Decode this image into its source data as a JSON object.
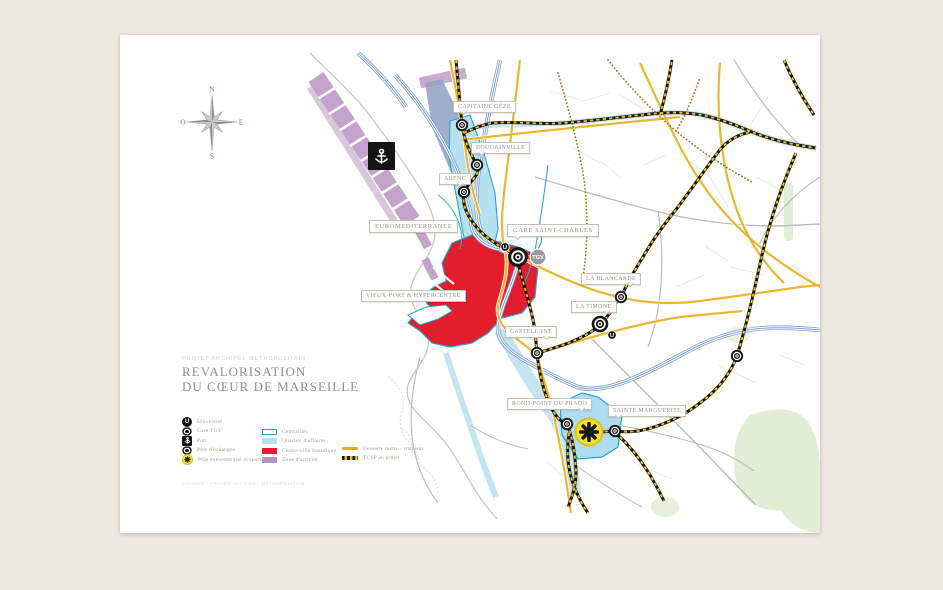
{
  "page": {
    "kicker": "PROJET ARCHIPEL METROPOLITAIN",
    "title_line1": "REVALORISATION",
    "title_line2": "DU CŒUR DE MARSEILLE",
    "credit": "SOURCE : PROJET ARCHIPEL METROPOLITAIN"
  },
  "compass": {
    "north": "N",
    "east": "E",
    "south": "S",
    "west": "O"
  },
  "map": {
    "labels": [
      {
        "id": "capitaine-geze",
        "text": "CAPITAINE GÈZE"
      },
      {
        "id": "bougainville",
        "text": "BOUGAINVILLE"
      },
      {
        "id": "arenc",
        "text": "ARENC"
      },
      {
        "id": "euromediterranee",
        "text": "EUROMEDITERRANEE"
      },
      {
        "id": "gare-saint-charles",
        "text": "GARE SAINT-CHARLES"
      },
      {
        "id": "vieux-port",
        "text": "VIEUX-PORT & HYPERCENTRE"
      },
      {
        "id": "la-blancarde",
        "text": "LA BLANCARDE"
      },
      {
        "id": "la-timone",
        "text": "LA TIMONE"
      },
      {
        "id": "castellane",
        "text": "CASTELLANE"
      },
      {
        "id": "rond-point-du-prado",
        "text": "ROND-POINT DU PRADO"
      },
      {
        "id": "sainte-marguerite",
        "text": "SAINTE MARGUERITE"
      }
    ],
    "badges": {
      "tgv": "TGV",
      "u1": "U",
      "u2": "U"
    }
  },
  "legend": {
    "points": [
      {
        "icon": "universite-icon",
        "label": "Université"
      },
      {
        "icon": "gare-tgv-icon",
        "label": "Gare TGV"
      },
      {
        "icon": "port-icon",
        "label": "Port"
      },
      {
        "icon": "pole-echanges-icon",
        "label": "Pôle d'échanges"
      },
      {
        "icon": "pole-evenementiel-icon",
        "label": "Pôle événementiel et sportif"
      }
    ],
    "areas": [
      {
        "swatch": "teal-outline",
        "label": "Centralités"
      },
      {
        "swatch": "light-blue",
        "label": "Quartier d'affaires"
      },
      {
        "swatch": "red",
        "label": "Centre-ville historique"
      },
      {
        "swatch": "purple",
        "label": "Zone d'activité"
      }
    ],
    "lines": [
      {
        "swatch": "yellow-solid",
        "label": "Desserte métro / tramway"
      },
      {
        "swatch": "black-yellow-dashed",
        "label": "TCSP en projet"
      }
    ]
  },
  "colors": {
    "background": "#ece9e1",
    "centre_ville_red": "#e31c2e",
    "quartier_blue": "#b7e1f1",
    "centralite_teal": "#2aa3c5",
    "zone_purple": "#b394c2",
    "road_yellow": "#e9b630",
    "tcsp_yellow": "#edbf1c",
    "rail_blue": "#7aa0d4",
    "park_green": "#e3ecd4"
  }
}
